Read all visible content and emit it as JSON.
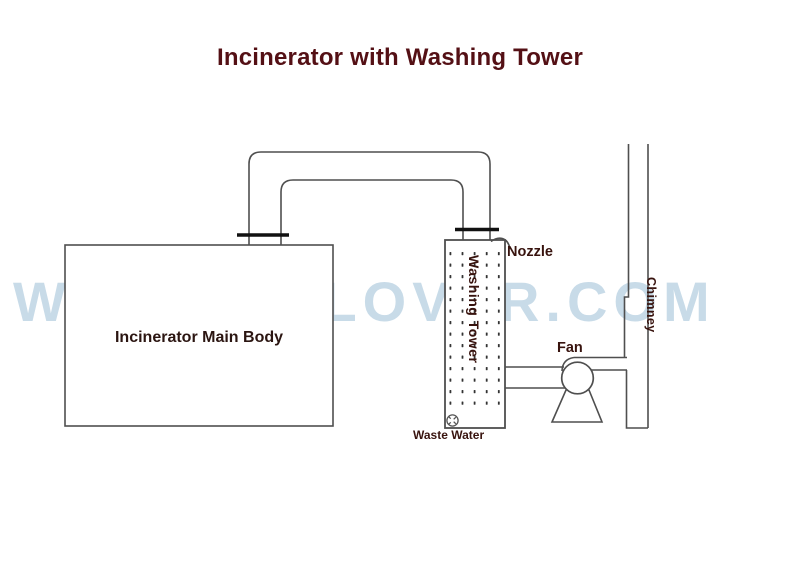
{
  "title": "Incinerator with Washing Tower",
  "watermark": "WWW.HICLOVER.COM",
  "labels": {
    "incinerator": "Incinerator Main Body",
    "nozzle": "Nozzle",
    "washing_tower": "Washing Tower",
    "fan": "Fan",
    "waste_water": "Waste Water",
    "chimney": "Chimney"
  },
  "colors": {
    "title_text": "#541015",
    "label_text": "#38130e",
    "watermark_text": "#c8dbe8",
    "diagram_line": "#4f4f4f",
    "flange": "#111111",
    "spray_dots": "#333333",
    "background": "#ffffff"
  }
}
